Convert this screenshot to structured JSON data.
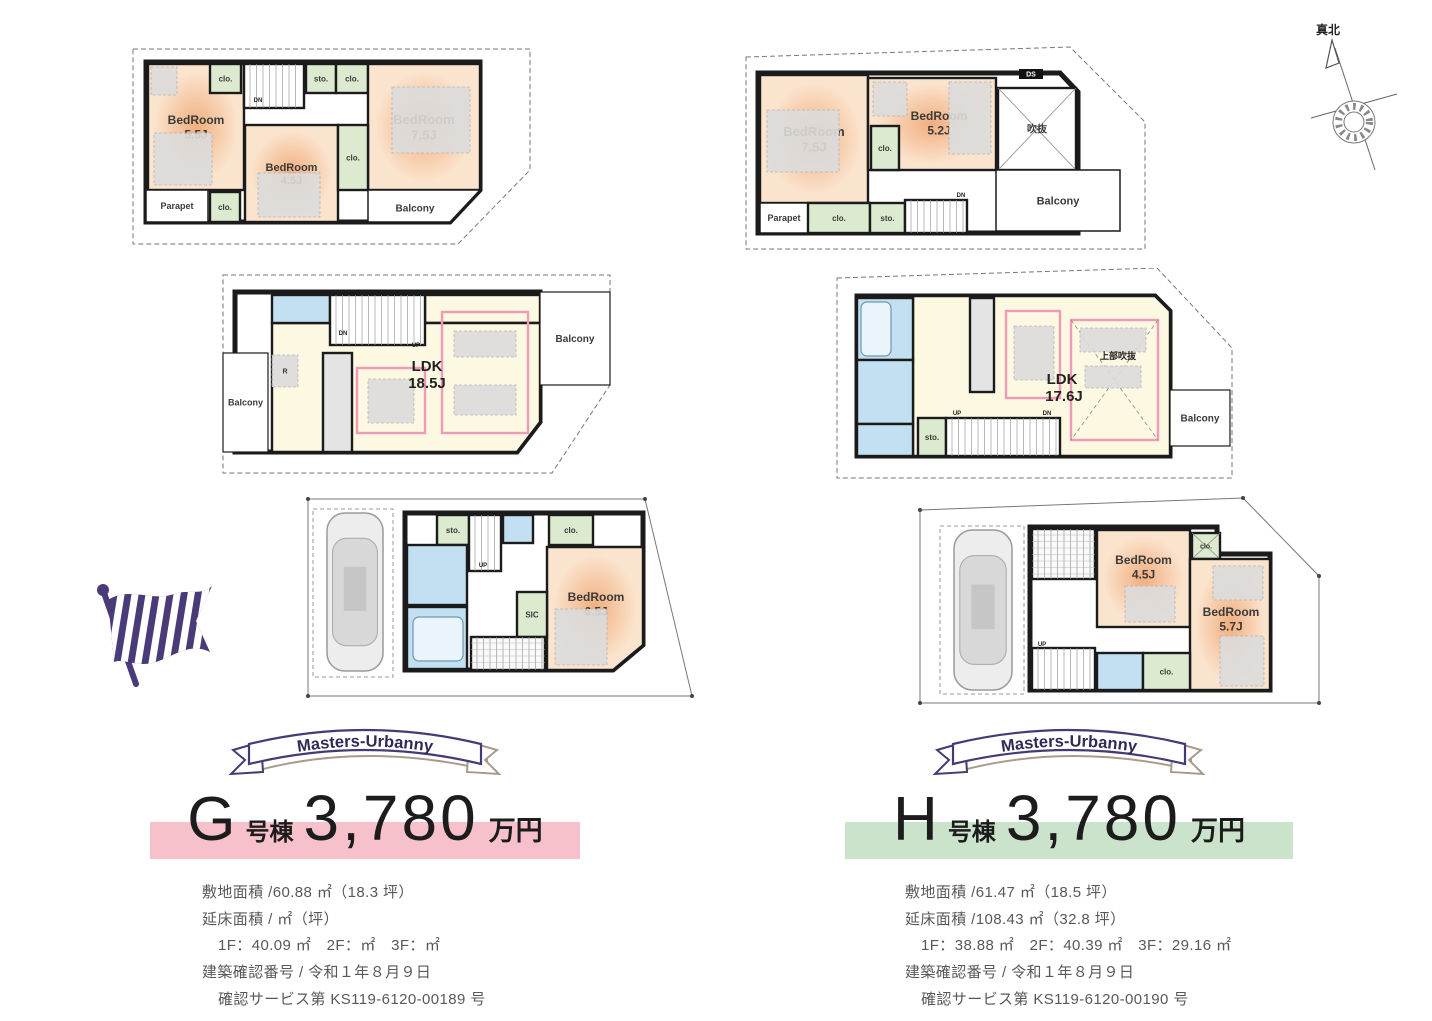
{
  "palette": {
    "wall": "#1b1b1b",
    "site": "#777777",
    "bed1": "#f1ae7e",
    "bed2": "#fbe4ce",
    "ldk": "#fdf8e2",
    "blue": "#c3e0f2",
    "green": "#dcebd0",
    "gray": "#e4e4e4",
    "white": "#ffffff",
    "pink": "#ef9ab6",
    "furn": "#dcdcdc",
    "flag": "#4a3a78",
    "ribbon": "#443a75",
    "ribbon2": "#a99a8c",
    "ribbonText": "#2f2a57"
  },
  "compass": {
    "label": "真北"
  },
  "units": [
    {
      "banner": "Masters-Urbanny",
      "name_letter": "G",
      "name_suffix": "号棟",
      "price": "3,780",
      "price_unit": "万円",
      "band_color": "#f7c1cc",
      "details": [
        "敷地面積 /60.88 ㎡（18.3 坪）",
        "延床面積 / ㎡（坪）",
        "1F：40.09 ㎡　2F：㎡　3F：㎡",
        "建築確認番号 / 令和１年８月９日",
        "確認サービス第 KS119-6120-00189 号"
      ]
    },
    {
      "banner": "Masters-Urbanny",
      "name_letter": "H",
      "name_suffix": "号棟",
      "price": "3,780",
      "price_unit": "万円",
      "band_color": "#cbe3ca",
      "details": [
        "敷地面積 /61.47 ㎡（18.5 坪）",
        "延床面積 /108.43 ㎡（32.8 坪）",
        "1F：38.88 ㎡　2F：40.39 ㎡　3F：29.16 ㎡",
        "建築確認番号 / 令和１年８月９日",
        "確認サービス第 KS119-6120-00190 号"
      ]
    }
  ],
  "plans": [
    {
      "id": "g3f",
      "x": 130,
      "y": 45,
      "w": 403,
      "h": 202,
      "site": "3,4 400,4 400,125 328,199 3,199",
      "bld": "16,17 350,17 350,145 320,177 16,177",
      "rooms": [
        {
          "k": "room",
          "x": 18,
          "y": 19,
          "w": 96,
          "h": 126,
          "f": "bed",
          "t": [
            "BedRoom",
            "5.5J"
          ],
          "ts": 12
        },
        {
          "k": "furn",
          "x": 24,
          "y": 88,
          "w": 58,
          "h": 52
        },
        {
          "k": "furn",
          "x": 21,
          "y": 22,
          "w": 26,
          "h": 28
        },
        {
          "k": "room",
          "x": 80,
          "y": 19,
          "w": 31,
          "h": 29,
          "f": "green",
          "t": [
            "clo."
          ],
          "ts": 8
        },
        {
          "k": "stairs-v",
          "x": 114,
          "y": 19,
          "w": 60,
          "h": 44
        },
        {
          "k": "room",
          "x": 176,
          "y": 19,
          "w": 30,
          "h": 29,
          "f": "green",
          "t": [
            "sto."
          ],
          "ts": 8
        },
        {
          "k": "room",
          "x": 206,
          "y": 19,
          "w": 32,
          "h": 29,
          "f": "green",
          "t": [
            "clo."
          ],
          "ts": 8
        },
        {
          "k": "room",
          "x": 238,
          "y": 19,
          "w": 112,
          "h": 126,
          "f": "bed",
          "t": [
            "BedRoom",
            "7.5J"
          ],
          "ts": 13
        },
        {
          "k": "furn",
          "x": 262,
          "y": 42,
          "w": 78,
          "h": 66
        },
        {
          "k": "room",
          "x": 115,
          "y": 80,
          "w": 93,
          "h": 97,
          "f": "bed",
          "t": [
            "BedRoom",
            "4.5J"
          ],
          "ts": 11
        },
        {
          "k": "furn",
          "x": 128,
          "y": 128,
          "w": 62,
          "h": 44
        },
        {
          "k": "room",
          "x": 208,
          "y": 80,
          "w": 30,
          "h": 65,
          "f": "green",
          "t": [
            "clo."
          ],
          "ts": 8
        },
        {
          "k": "room",
          "x": 16,
          "y": 145,
          "w": 62,
          "h": 32,
          "f": "white",
          "sw": 1.5,
          "t": [
            "Parapet"
          ],
          "ts": 9
        },
        {
          "k": "room",
          "x": 80,
          "y": 147,
          "w": 30,
          "h": 30,
          "f": "green",
          "t": [
            "clo."
          ],
          "ts": 8
        },
        {
          "k": "poly",
          "pts": "238,145 350,145 320,177 238,177",
          "f": "white",
          "sw": 1.5,
          "t": [
            "Balcony"
          ],
          "ts": 10,
          "tx": 285,
          "ty": 163
        }
      ],
      "labels": [
        {
          "t": "DN",
          "x": 128,
          "y": 57,
          "s": 6
        }
      ]
    },
    {
      "id": "h3f",
      "x": 743,
      "y": 42,
      "w": 405,
      "h": 210,
      "site": "3,15 327,5 402,80 402,207 3,207",
      "bld": "15,31 317,31 335,50 335,191 15,191",
      "rooms": [
        {
          "k": "room",
          "x": 17,
          "y": 33,
          "w": 108,
          "h": 128,
          "f": "bed",
          "t": [
            "BedRoom",
            "7.5J"
          ],
          "ts": 13
        },
        {
          "k": "furn",
          "x": 24,
          "y": 68,
          "w": 72,
          "h": 62
        },
        {
          "k": "room",
          "x": 125,
          "y": 36,
          "w": 128,
          "h": 92,
          "f": "bed",
          "t": [
            "BedRoom",
            "5.2J"
          ],
          "ts": 12,
          "tx": 196,
          "ty": 74
        },
        {
          "k": "furn",
          "x": 206,
          "y": 40,
          "w": 42,
          "h": 72
        },
        {
          "k": "furn",
          "x": 130,
          "y": 40,
          "w": 34,
          "h": 34
        },
        {
          "k": "room",
          "x": 128,
          "y": 84,
          "w": 28,
          "h": 44,
          "f": "green",
          "t": [
            "clo."
          ],
          "ts": 8
        },
        {
          "k": "xbox",
          "x": 255,
          "y": 46,
          "w": 78,
          "h": 82,
          "f": "white",
          "t": [
            "吹抜"
          ],
          "ts": 10
        },
        {
          "k": "tag",
          "x": 276,
          "y": 27,
          "w": 24,
          "h": 10,
          "t": [
            "DS"
          ],
          "ts": 7
        },
        {
          "k": "room",
          "x": 17,
          "y": 161,
          "w": 48,
          "h": 30,
          "f": "white",
          "sw": 1.5,
          "t": [
            "Parapet"
          ],
          "ts": 9
        },
        {
          "k": "room",
          "x": 65,
          "y": 161,
          "w": 62,
          "h": 30,
          "f": "green",
          "t": [
            "clo."
          ],
          "ts": 8
        },
        {
          "k": "room",
          "x": 127,
          "y": 161,
          "w": 35,
          "h": 30,
          "f": "green",
          "t": [
            "sto."
          ],
          "ts": 8
        },
        {
          "k": "stairs-v",
          "x": 162,
          "y": 158,
          "w": 62,
          "h": 33
        },
        {
          "k": "room",
          "x": 253,
          "y": 128,
          "w": 124,
          "h": 61,
          "f": "white",
          "sw": 1.5,
          "t": [
            "Balcony"
          ],
          "ts": 11
        }
      ],
      "labels": [
        {
          "t": "DN",
          "x": 218,
          "y": 155,
          "s": 6
        }
      ]
    },
    {
      "id": "g2f",
      "x": 220,
      "y": 273,
      "w": 395,
      "h": 202,
      "site": "3,2 390,2 390,112 332,200 3,200",
      "bld": "15,19 320,19 320,149 297,179 15,179",
      "rooms": [
        {
          "k": "room",
          "x": 3,
          "y": 80,
          "w": 45,
          "h": 99,
          "f": "white",
          "sw": 1.2,
          "t": [
            "Balcony"
          ],
          "ts": 9
        },
        {
          "k": "room",
          "x": 205,
          "y": 22,
          "w": 115,
          "h": 28,
          "f": "ldk"
        },
        {
          "k": "poly",
          "pts": "52,50 320,50 320,149 297,179 52,179",
          "f": "ldk"
        },
        {
          "k": "room",
          "x": 52,
          "y": 22,
          "w": 58,
          "h": 28,
          "f": "blue"
        },
        {
          "k": "stairs-v",
          "x": 110,
          "y": 22,
          "w": 95,
          "h": 50
        },
        {
          "k": "room",
          "x": 103,
          "y": 80,
          "w": 29,
          "h": 99,
          "f": "gray"
        },
        {
          "k": "furn",
          "x": 52,
          "y": 82,
          "w": 26,
          "h": 32,
          "t": [
            "R"
          ],
          "ts": 7
        },
        {
          "k": "pink",
          "x": 137,
          "y": 95,
          "w": 68,
          "h": 65
        },
        {
          "k": "furn",
          "x": 148,
          "y": 106,
          "w": 46,
          "h": 44
        },
        {
          "k": "pink",
          "x": 222,
          "y": 39,
          "w": 86,
          "h": 121
        },
        {
          "k": "furn",
          "x": 234,
          "y": 58,
          "w": 62,
          "h": 26
        },
        {
          "k": "furn",
          "x": 234,
          "y": 112,
          "w": 62,
          "h": 30
        },
        {
          "k": "room",
          "x": 320,
          "y": 19,
          "w": 70,
          "h": 93,
          "f": "white",
          "sw": 1.2,
          "t": [
            "Balcony"
          ],
          "ts": 10
        }
      ],
      "labels": [
        {
          "t": "LDK",
          "x": 207,
          "y": 98,
          "s": 15
        },
        {
          "t": "18.5J",
          "x": 207,
          "y": 115,
          "s": 15
        },
        {
          "t": "DN",
          "x": 123,
          "y": 62,
          "s": 6
        },
        {
          "t": "UP",
          "x": 196,
          "y": 74,
          "s": 6
        }
      ]
    },
    {
      "id": "h2f",
      "x": 835,
      "y": 268,
      "w": 400,
      "h": 212,
      "site": "2,10 322,0 397,80 397,210 2,210",
      "bld": "22,28 320,28 335,43 335,188 22,188",
      "rooms": [
        {
          "k": "poly",
          "pts": "78,28 320,28 335,43 335,188 78,188",
          "f": "ldk"
        },
        {
          "k": "room",
          "x": 22,
          "y": 30,
          "w": 56,
          "h": 62,
          "f": "blue"
        },
        {
          "k": "tub",
          "x": 26,
          "y": 34,
          "w": 30,
          "h": 54
        },
        {
          "k": "room",
          "x": 22,
          "y": 92,
          "w": 56,
          "h": 64,
          "f": "blue"
        },
        {
          "k": "room",
          "x": 22,
          "y": 156,
          "w": 56,
          "h": 32,
          "f": "blue"
        },
        {
          "k": "room",
          "x": 83,
          "y": 150,
          "w": 28,
          "h": 38,
          "f": "green",
          "t": [
            "sto."
          ],
          "ts": 8
        },
        {
          "k": "stairs-v",
          "x": 111,
          "y": 150,
          "w": 114,
          "h": 38
        },
        {
          "k": "room",
          "x": 135,
          "y": 30,
          "w": 24,
          "h": 94,
          "f": "gray"
        },
        {
          "k": "pink",
          "x": 171,
          "y": 43,
          "w": 54,
          "h": 87
        },
        {
          "k": "furn",
          "x": 179,
          "y": 58,
          "w": 40,
          "h": 54
        },
        {
          "k": "pink",
          "x": 236,
          "y": 52,
          "w": 87,
          "h": 120
        },
        {
          "k": "xd",
          "x": 236,
          "y": 52,
          "w": 87,
          "h": 120
        },
        {
          "k": "furn",
          "x": 245,
          "y": 60,
          "w": 66,
          "h": 24
        },
        {
          "k": "furn",
          "x": 250,
          "y": 98,
          "w": 56,
          "h": 22
        },
        {
          "k": "room",
          "x": 335,
          "y": 122,
          "w": 60,
          "h": 56,
          "f": "white",
          "sw": 1.2,
          "t": [
            "Balcony"
          ],
          "ts": 10
        }
      ],
      "labels": [
        {
          "t": "上部吹抜",
          "x": 283,
          "y": 91,
          "s": 9
        },
        {
          "t": "LDK",
          "x": 227,
          "y": 116,
          "s": 15
        },
        {
          "t": "17.6J",
          "x": 229,
          "y": 133,
          "s": 15
        },
        {
          "t": "UP",
          "x": 122,
          "y": 147,
          "s": 6
        },
        {
          "t": "DN",
          "x": 212,
          "y": 147,
          "s": 6
        }
      ]
    },
    {
      "id": "g1f",
      "x": 293,
      "y": 497,
      "w": 402,
      "h": 202,
      "dots": 1,
      "site": "15,2 352,2 399,199 15,199",
      "bld": "112,16 350,16 350,148 320,173 112,173",
      "rooms": [
        {
          "k": "dash",
          "x": 20,
          "y": 12,
          "w": 80,
          "h": 168
        },
        {
          "k": "car",
          "x": 34,
          "y": 16,
          "w": 56,
          "h": 158
        },
        {
          "k": "room",
          "x": 144,
          "y": 18,
          "w": 32,
          "h": 30,
          "f": "green",
          "t": [
            "sto."
          ],
          "ts": 8
        },
        {
          "k": "stairs-v",
          "x": 176,
          "y": 18,
          "w": 32,
          "h": 56
        },
        {
          "k": "room",
          "x": 114,
          "y": 48,
          "w": 60,
          "h": 60,
          "f": "blue"
        },
        {
          "k": "room",
          "x": 114,
          "y": 110,
          "w": 60,
          "h": 62,
          "f": "blue"
        },
        {
          "k": "tub",
          "x": 120,
          "y": 120,
          "w": 50,
          "h": 44
        },
        {
          "k": "room",
          "x": 210,
          "y": 18,
          "w": 30,
          "h": 28,
          "f": "blue"
        },
        {
          "k": "room",
          "x": 256,
          "y": 18,
          "w": 44,
          "h": 30,
          "f": "green",
          "t": [
            "clo."
          ],
          "ts": 8
        },
        {
          "k": "poly",
          "pts": "254,50 350,50 350,148 320,173 254,173",
          "f": "bed",
          "t": [
            "BedRoom",
            "6.5J"
          ],
          "ts": 12,
          "tx": 303,
          "ty": 100
        },
        {
          "k": "furn",
          "x": 262,
          "y": 112,
          "w": 52,
          "h": 56
        },
        {
          "k": "room",
          "x": 224,
          "y": 95,
          "w": 30,
          "h": 45,
          "f": "green",
          "t": [
            "SIC"
          ],
          "ts": 8
        },
        {
          "k": "grid",
          "x": 178,
          "y": 140,
          "w": 74,
          "h": 33
        }
      ],
      "labels": [
        {
          "t": "UP",
          "x": 190,
          "y": 70,
          "s": 6
        }
      ]
    },
    {
      "id": "h1f",
      "x": 915,
      "y": 496,
      "w": 407,
      "h": 212,
      "dots": 1,
      "site": "5,14 328,2 404,80 404,207 5,207",
      "bld": "115,31 302,31 302,58 355,58 355,194 115,194",
      "rooms": [
        {
          "k": "dash",
          "x": 25,
          "y": 30,
          "w": 84,
          "h": 168
        },
        {
          "k": "car",
          "x": 39,
          "y": 34,
          "w": 58,
          "h": 160
        },
        {
          "k": "grid",
          "x": 117,
          "y": 33,
          "w": 63,
          "h": 50
        },
        {
          "k": "room",
          "x": 182,
          "y": 34,
          "w": 93,
          "h": 97,
          "f": "bed",
          "t": [
            "BedRoom",
            "4.5J"
          ],
          "ts": 12,
          "ty": 64
        },
        {
          "k": "furn",
          "x": 210,
          "y": 90,
          "w": 50,
          "h": 36
        },
        {
          "k": "xbox",
          "x": 277,
          "y": 37,
          "w": 28,
          "h": 26,
          "f": "green",
          "t": [
            "clo."
          ],
          "ts": 7
        },
        {
          "k": "room",
          "x": 275,
          "y": 63,
          "w": 80,
          "h": 131,
          "f": "bed",
          "t": [
            "BedRoom",
            "5.7J"
          ],
          "ts": 12,
          "tx": 316,
          "ty": 116
        },
        {
          "k": "furn",
          "x": 298,
          "y": 70,
          "w": 50,
          "h": 34
        },
        {
          "k": "furn",
          "x": 305,
          "y": 140,
          "w": 44,
          "h": 50
        },
        {
          "k": "stairs-v",
          "x": 117,
          "y": 152,
          "w": 63,
          "h": 42
        },
        {
          "k": "room",
          "x": 182,
          "y": 157,
          "w": 46,
          "h": 37,
          "f": "blue"
        },
        {
          "k": "room",
          "x": 228,
          "y": 157,
          "w": 47,
          "h": 37,
          "f": "green",
          "t": [
            "clo."
          ],
          "ts": 8
        }
      ],
      "labels": [
        {
          "t": "UP",
          "x": 127,
          "y": 150,
          "s": 6
        }
      ]
    }
  ]
}
